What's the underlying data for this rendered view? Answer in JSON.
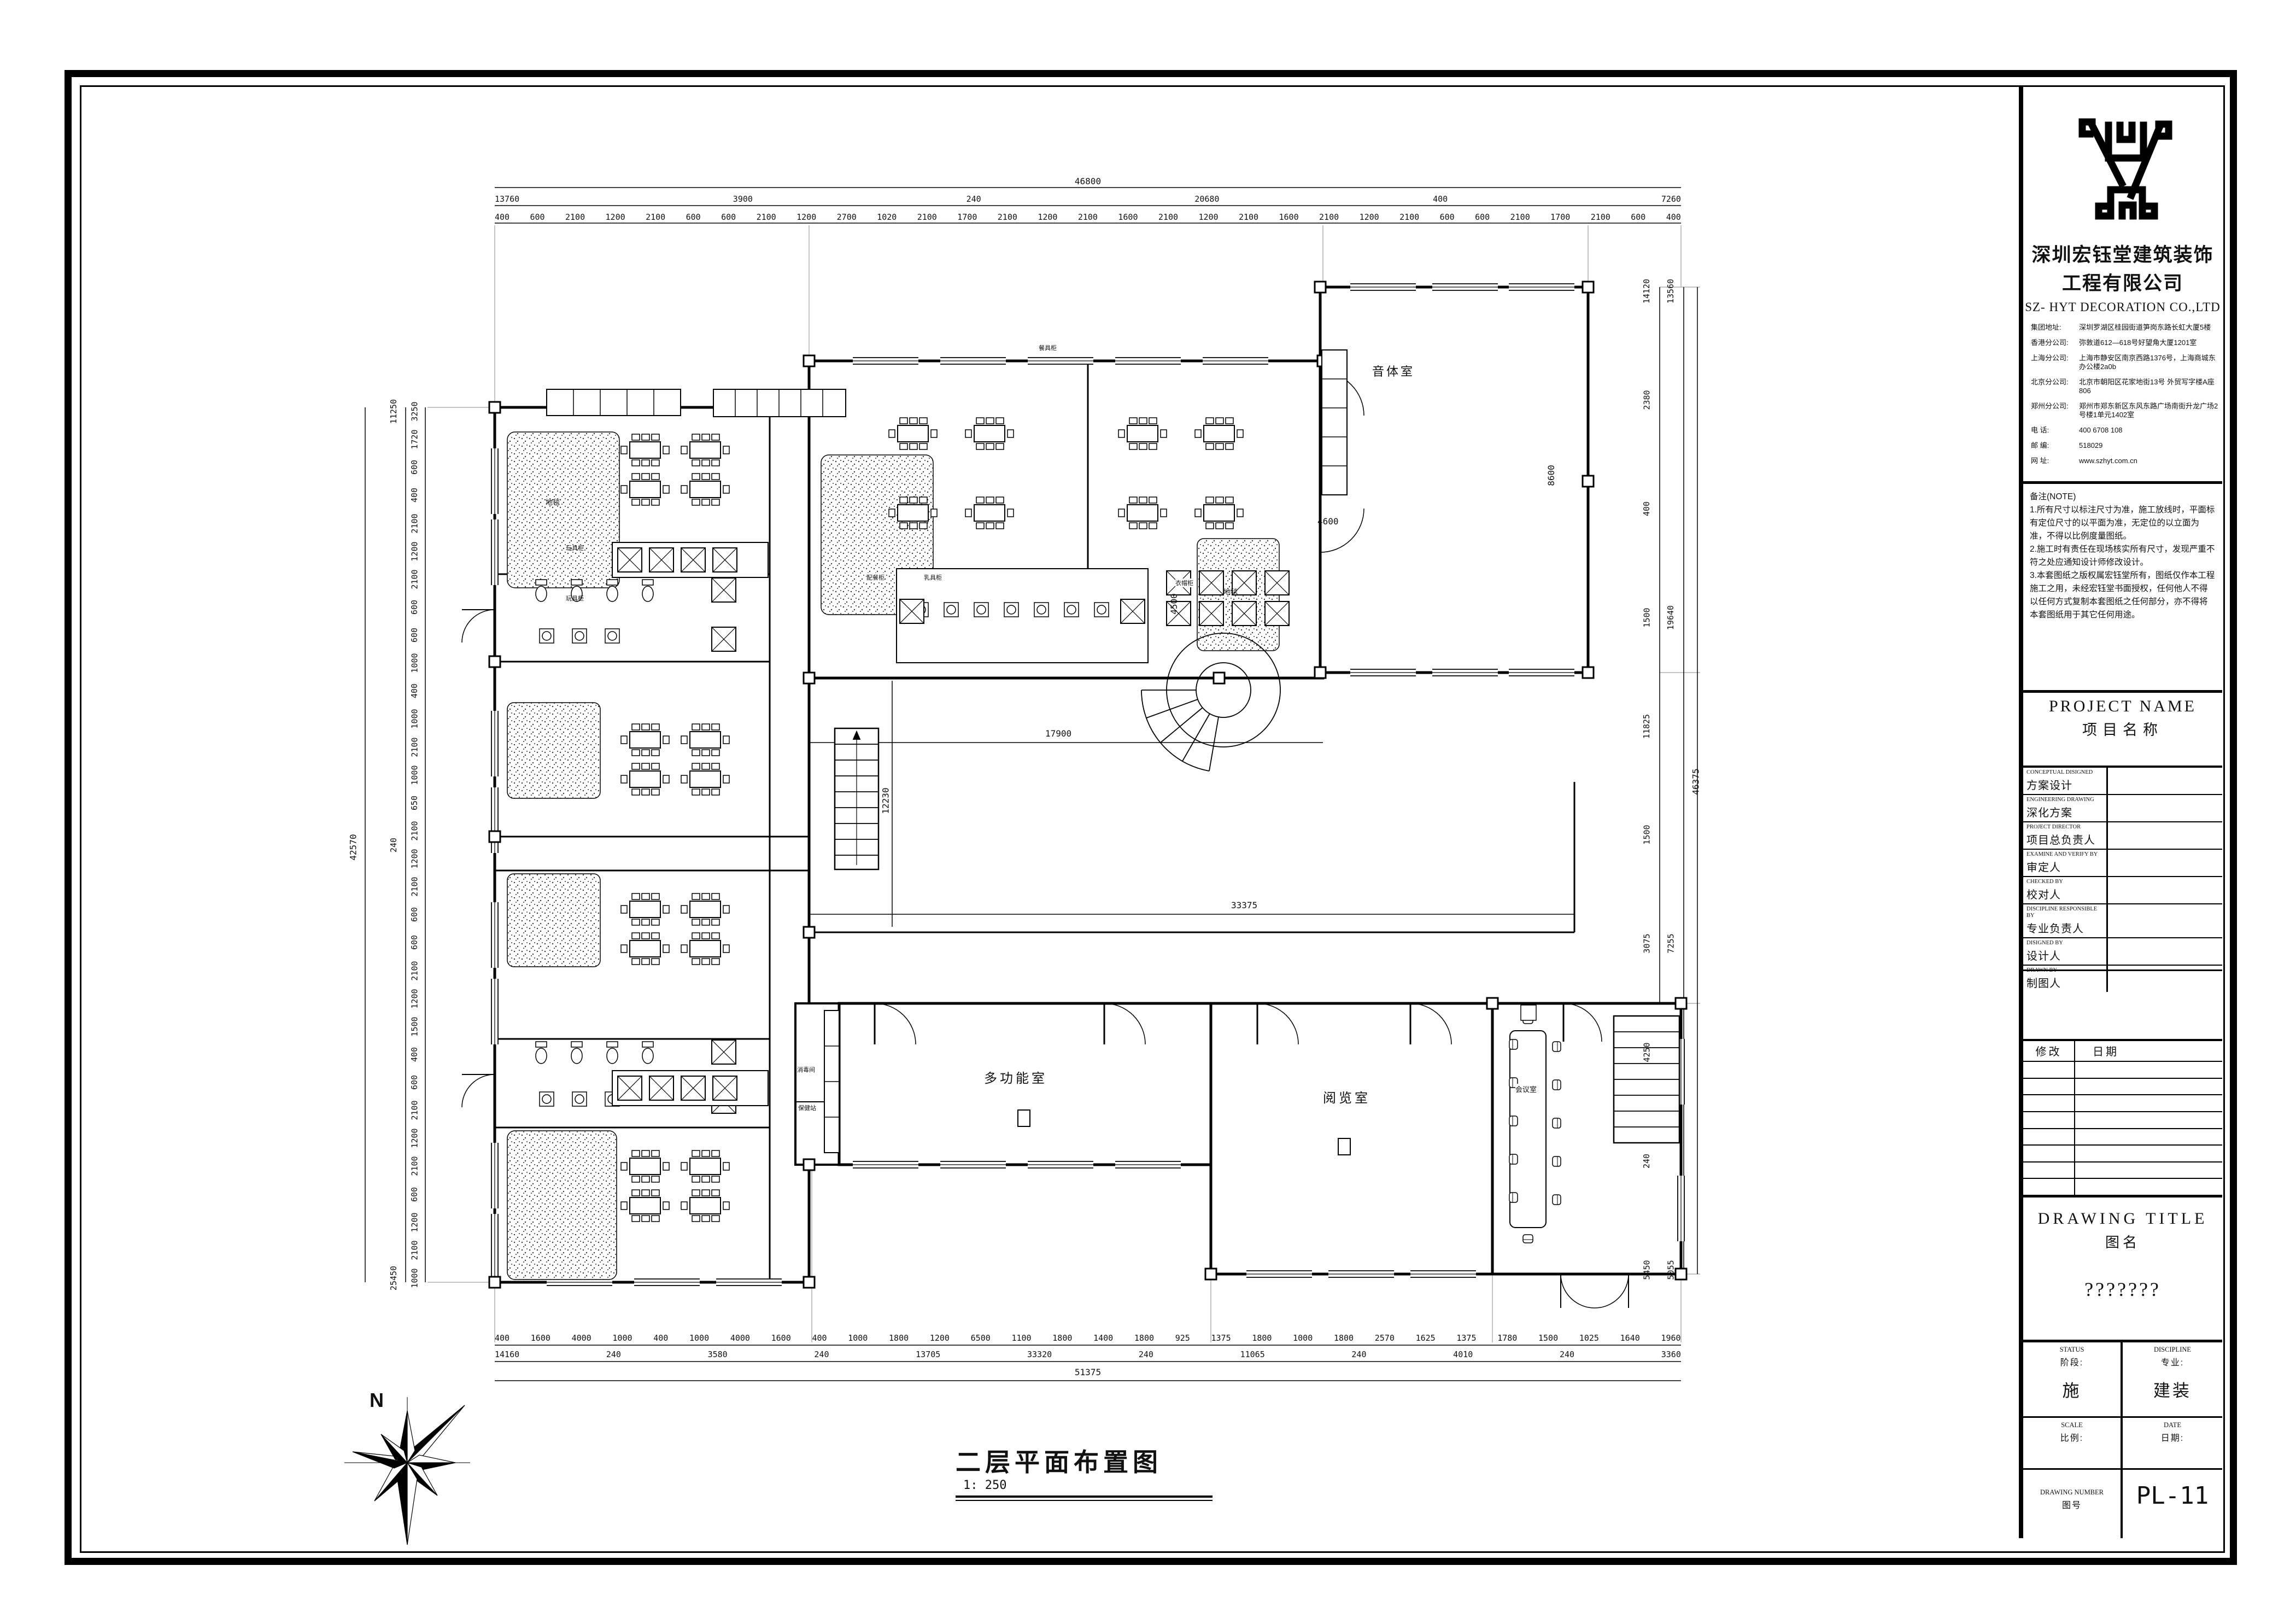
{
  "title_block": {
    "company_cn_1": "深圳宏钰堂建筑装饰",
    "company_cn_2": "工程有限公司",
    "company_en": "SZ- HYT DECORATION CO.,LTD",
    "addresses": [
      {
        "label": "集团地址:",
        "text": "深圳罗湖区桂园街道笋岗东路长虹大厦5楼"
      },
      {
        "label": "香港分公司:",
        "text": "弥敦道612—618号好望角大厦1201室"
      },
      {
        "label": "上海分公司:",
        "text": "上海市静安区南京西路1376号，上海商城东办公楼2a0b"
      },
      {
        "label": "北京分公司:",
        "text": "北京市朝阳区花家地街13号 外贸写字楼A座806"
      },
      {
        "label": "郑州分公司:",
        "text": "郑州市郑东新区东风东路广场南街升龙广场2号楼1单元1402室"
      },
      {
        "label": "电 话:",
        "text": "400 6708 108"
      },
      {
        "label": "邮 编:",
        "text": "518029"
      },
      {
        "label": "网 址:",
        "text": "www.szhyt.com.cn"
      }
    ],
    "notes_title": "备注(NOTE)",
    "notes": [
      "1.所有尺寸以标注尺寸为准，施工放线时，平面标有定位尺寸的以平面为准，无定位的以立面为准，不得以比例度量图纸。",
      "2.施工时有责任在现场核实所有尺寸，发现严重不符之处应通知设计师修改设计。",
      "3.本套图纸之版权属宏钰堂所有，图纸仅作本工程施工之用，未经宏钰堂书面授权，任何他人不得以任何方式复制本套图纸之任何部分，亦不得将本套图纸用于其它任何用途。"
    ],
    "project_name_en": "PROJECT NAME",
    "project_name_cn": "项目名称",
    "sign_rows": [
      {
        "en": "CONCEPTUAL DISIGNED",
        "cn": "方案设计"
      },
      {
        "en": "ENGINEERING DRAWING",
        "cn": "深化方案"
      },
      {
        "en": "PROJECT DIRECTOR",
        "cn": "项目总负责人"
      },
      {
        "en": "EXAMINE AND VERIFY BY",
        "cn": "审定人"
      },
      {
        "en": "CHECKED BY",
        "cn": "校对人"
      },
      {
        "en": "DISCIPLINE RESPONSIBLE BY",
        "cn": "专业负责人"
      },
      {
        "en": "DISIGNED BY",
        "cn": "设计人"
      },
      {
        "en": "DRAWN BY",
        "cn": "制图人"
      }
    ],
    "revision_header": {
      "modify": "修改",
      "date": "日期"
    },
    "drawing_title_en": "DRAWING TITLE",
    "drawing_title_cn": "图名",
    "drawing_title_value": "???????",
    "status_en": "STATUS",
    "status_cn": "阶段:",
    "status_value": "施",
    "discipline_en": "DISCIPLINE",
    "discipline_cn": "专业:",
    "discipline_value": "建装",
    "scale_en": "SCALE",
    "scale_cn": "比例:",
    "date_en": "DATE",
    "date_cn": "日期:",
    "number_en": "DRAWING NUMBER",
    "number_cn": "图号",
    "number_value": "PL-11"
  },
  "plan": {
    "caption": "二层平面布置图",
    "caption_scale": "1: 250",
    "north_label": "N",
    "rooms": {
      "music": "音体室",
      "multi": "多功能室",
      "reading": "阅览室",
      "meeting": "会议室",
      "disinfect": "消毒间",
      "health": "保健站"
    },
    "small_labels": {
      "carpet": "地毯",
      "carpet2": "地毯",
      "toy_cabinet_1": "玩具柜",
      "toy_cabinet_2": "玩具柜",
      "coat_cabinet": "衣帽柜",
      "serve_cabinet": "配餐柜",
      "milk_cabinet": "乳具柜",
      "dish_cabinet": "餐具柜"
    },
    "dims": {
      "top_total": "46800",
      "top_row2": [
        "13760",
        "3900",
        "240",
        "20680",
        "400",
        "7260"
      ],
      "top_chain": [
        "400",
        "600",
        "2100",
        "1200",
        "2100",
        "600",
        "600",
        "2100",
        "1200",
        "2700",
        "1020",
        "2100",
        "1700",
        "2100",
        "1200",
        "2100",
        "1600",
        "2100",
        "1200",
        "2100",
        "1600",
        "2100",
        "1200",
        "2100",
        "600",
        "600",
        "2100",
        "1700",
        "2100",
        "600",
        "400"
      ],
      "bottom_chain": [
        "400",
        "1600",
        "4000",
        "1000",
        "400",
        "1000",
        "4000",
        "1600",
        "400",
        "1000",
        "1800",
        "1200",
        "6500",
        "1100",
        "1800",
        "1400",
        "1800",
        "925",
        "1375",
        "1800",
        "1000",
        "1800",
        "2570",
        "1625",
        "1375",
        "1780",
        "1500",
        "1025",
        "1640",
        "1960"
      ],
      "bottom_row2": [
        "14160",
        "240",
        "3580",
        "240",
        "13705",
        "33320",
        "240",
        "11065",
        "240",
        "4010",
        "240",
        "3360"
      ],
      "bottom_total": "51375",
      "left_chain": [
        "3250",
        "1720",
        "600",
        "400",
        "2100",
        "1200",
        "2100",
        "600",
        "600",
        "1000",
        "400",
        "1000",
        "2100",
        "1000",
        "650",
        "2100",
        "1200",
        "2100",
        "600",
        "600",
        "2100",
        "1200",
        "1500",
        "400",
        "600",
        "2100",
        "1200",
        "2100",
        "600",
        "1200",
        "2100",
        "1000"
      ],
      "left_row2": [
        "11250",
        "240",
        "25450"
      ],
      "left_total": "42570",
      "right_col1": [
        "14120",
        "2380",
        "400",
        "1500",
        "11825",
        "1500",
        "3075",
        "4250",
        "240",
        "5450"
      ],
      "right_col2": [
        "13560",
        "19640",
        "7255",
        "5055"
      ],
      "right_total": "46375",
      "inner_17900": "17900",
      "inner_33375": "33375",
      "inner_4600": "4600",
      "inner_8600": "8600",
      "inner_4500": "4500",
      "inner_12230": "12230"
    }
  }
}
